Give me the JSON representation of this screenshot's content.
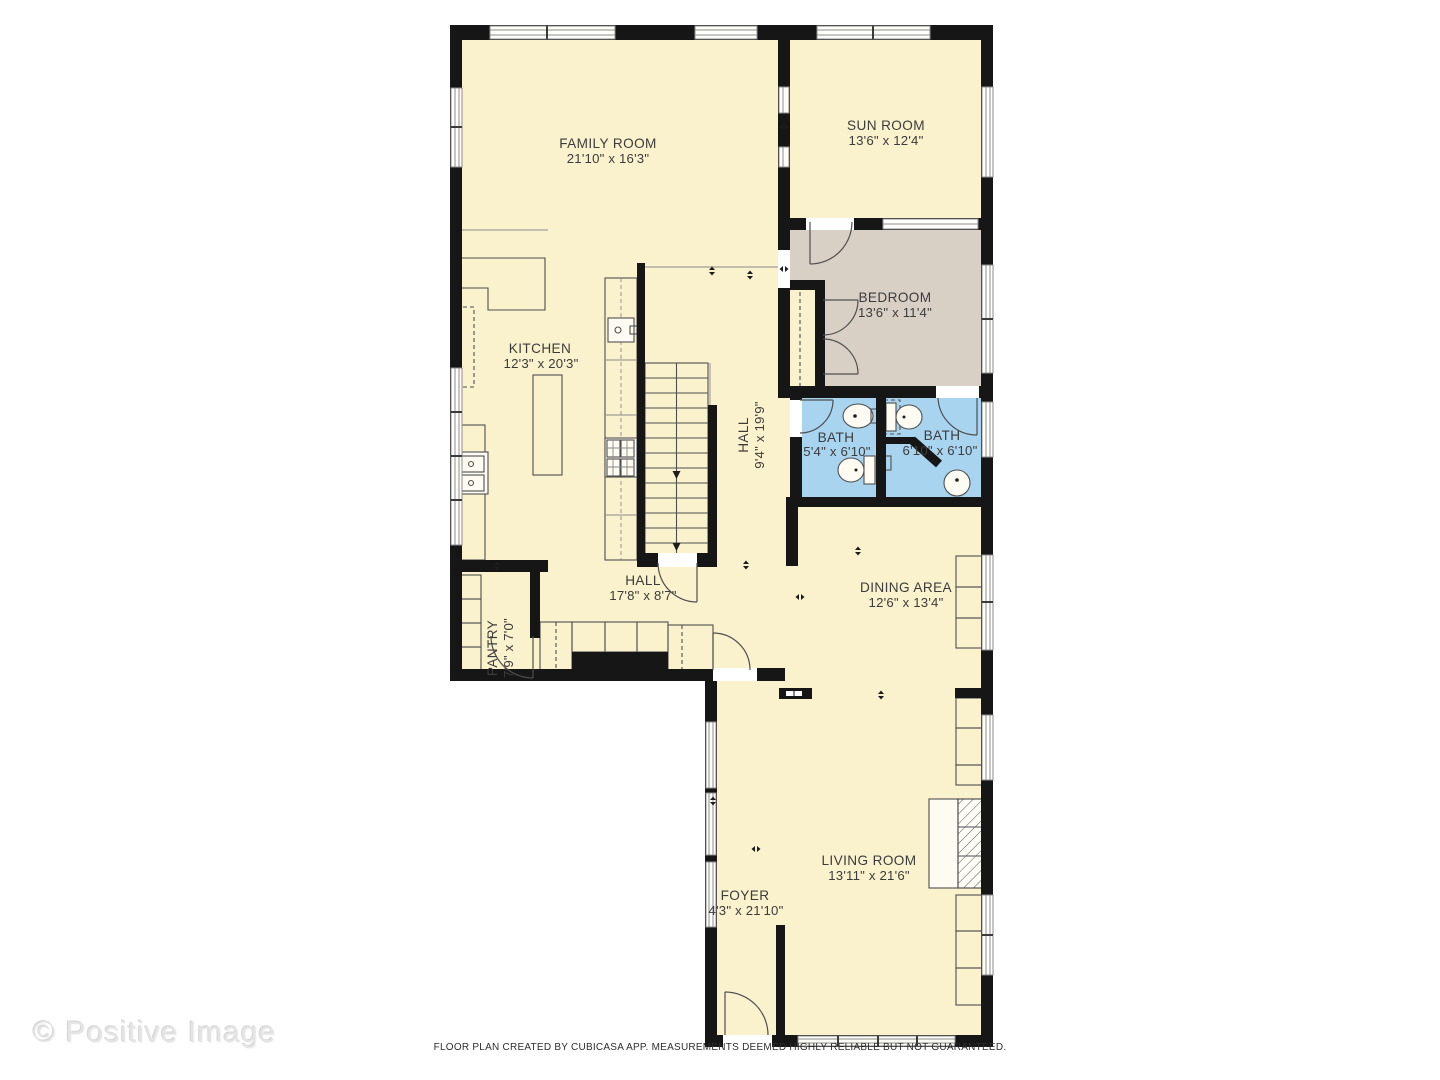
{
  "plan": {
    "rooms": {
      "family_room": {
        "name": "FAMILY ROOM",
        "dims": "21'10\" x 16'3\""
      },
      "sun_room": {
        "name": "SUN ROOM",
        "dims": "13'6\" x 12'4\""
      },
      "bedroom": {
        "name": "BEDROOM",
        "dims": "13'6\" x 11'4\""
      },
      "kitchen": {
        "name": "KITCHEN",
        "dims": "12'3\" x 20'3\""
      },
      "hall_upper": {
        "name": "HALL",
        "dims": "9'4\" x 19'9\""
      },
      "bath_left": {
        "name": "BATH",
        "dims": "5'4\" x 6'10\""
      },
      "bath_right": {
        "name": "BATH",
        "dims": "6'10\" x 6'10\""
      },
      "hall_lower": {
        "name": "HALL",
        "dims": "17'8\" x 8'7\""
      },
      "pantry": {
        "name": "PANTRY",
        "dims": "7'9\" x 7'0\""
      },
      "dining_area": {
        "name": "DINING AREA",
        "dims": "12'6\" x 13'4\""
      },
      "living_room": {
        "name": "LIVING ROOM",
        "dims": "13'11\" x 21'6\""
      },
      "foyer": {
        "name": "FOYER",
        "dims": "4'3\" x 21'10\""
      }
    },
    "colors": {
      "floor": "#FAF1CD",
      "bedroom_floor": "#D8D0C5",
      "bath_floor": "#A8D4F0",
      "wall": "#161616"
    }
  },
  "watermark": "© Positive Image",
  "footer": "FLOOR PLAN CREATED BY CUBICASA APP. MEASUREMENTS DEEMED HIGHLY RELIABLE BUT NOT GUARANTEED."
}
